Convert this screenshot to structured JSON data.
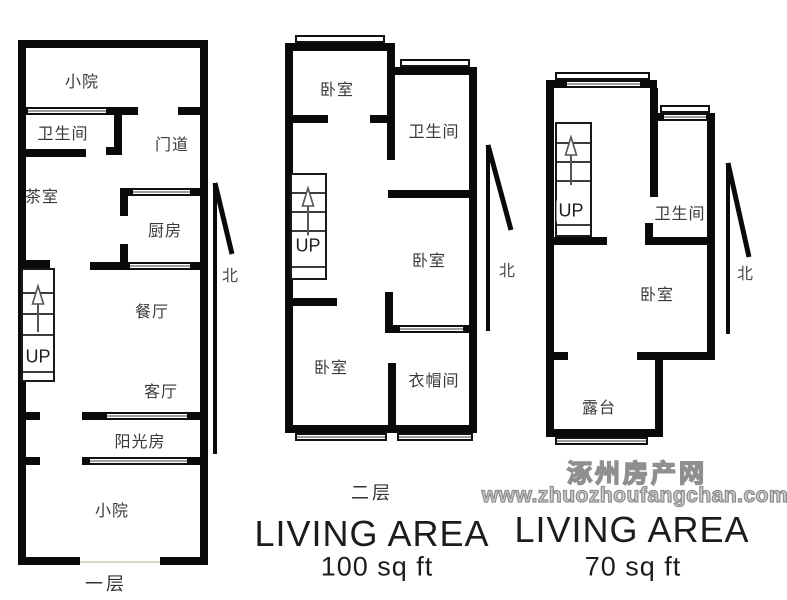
{
  "plan1": {
    "floor_label": "一层",
    "up": "UP",
    "north": "北",
    "rooms": {
      "yard_top": "小院",
      "bathroom": "卫生间",
      "doorway": "门道",
      "tea_room": "茶室",
      "kitchen": "厨房",
      "dining_room": "餐厅",
      "living_room": "客厅",
      "sunroom": "阳光房",
      "yard_bottom": "小院"
    }
  },
  "plan2": {
    "floor_label": "二层",
    "up": "UP",
    "north": "北",
    "area_title": "LIVING AREA",
    "area_value": "100 sq ft",
    "rooms": {
      "bedroom_top": "卧室",
      "bathroom": "卫生间",
      "bedroom_middle": "卧室",
      "bedroom_bottom": "卧室",
      "cloakroom": "衣帽间"
    }
  },
  "plan3": {
    "up": "UP",
    "north": "北",
    "area_title": "LIVING AREA",
    "area_value": "70 sq ft",
    "rooms": {
      "bathroom": "卫生间",
      "bedroom": "卧室",
      "terrace": "露台"
    }
  },
  "watermark": {
    "site_name": "涿州房产网",
    "site_url": "www.zhuozhoufangchan.com"
  },
  "colors": {
    "wall": "#0a0a0a",
    "window_glass": "#9e9e9e",
    "watermark_gray": "#8f8f8f"
  }
}
